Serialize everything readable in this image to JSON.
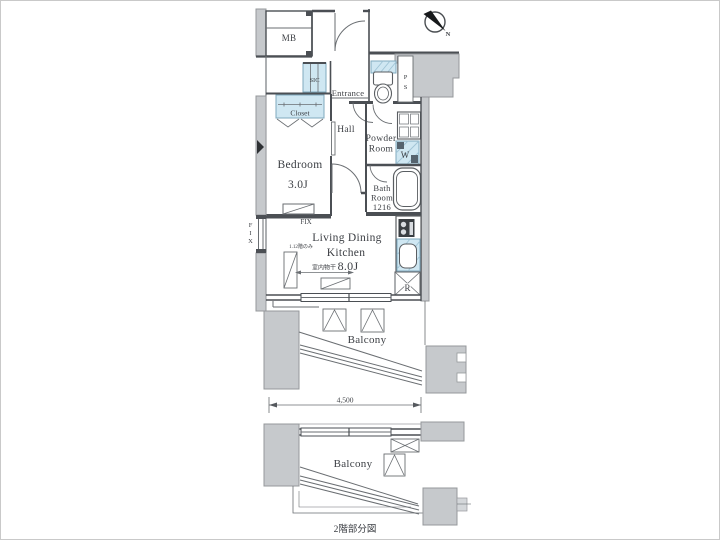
{
  "colors": {
    "wall_gray": "#c6c9cc",
    "water_blue": "#cfe7f2",
    "line_dark": "#4b4f54"
  },
  "rooms": {
    "mb": "MB",
    "sic": "SIC",
    "entrance": "Entrance",
    "closet": "Closet",
    "hall": "Hall",
    "bedroom": {
      "name": "Bedroom",
      "size": "3.0J"
    },
    "powder": {
      "line1": "Powder",
      "line2": "Room"
    },
    "bath": {
      "line1": "Bath",
      "line2": "Room",
      "line3": "1216"
    },
    "ldk": {
      "line1": "Living Dining",
      "line2": "Kitchen",
      "size": "8.0J"
    },
    "balcony_main": "Balcony",
    "balcony_lower": "Balcony"
  },
  "fixtures": {
    "washer": "W",
    "refrigerator": "R"
  },
  "shaft": {
    "letters": [
      "P",
      "S"
    ]
  },
  "windows": {
    "fix_vertical_letters": [
      "F",
      "I",
      "X"
    ],
    "fix_horizontal": "FIX"
  },
  "annotations": {
    "indoor_drying": "室内物干",
    "floor_note": "1.12階のみ",
    "dimension_width": "4,500",
    "caption": "2階部分図",
    "north": "N"
  }
}
